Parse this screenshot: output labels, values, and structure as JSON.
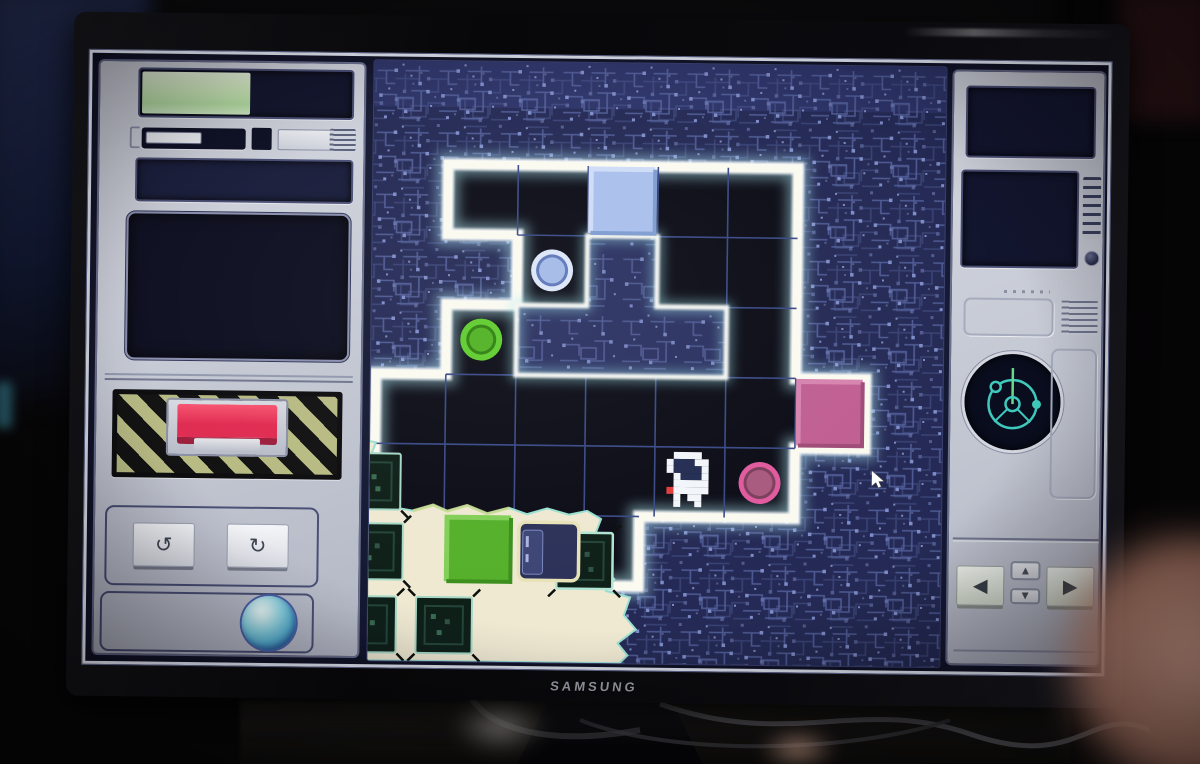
{
  "monitor": {
    "brand": "SAMSUNG"
  },
  "hud": {
    "left_panel": {
      "progress_bar": {
        "value_percent": 51,
        "fill_color": "#cdeab8",
        "track_color": "#10132a"
      },
      "slider": {
        "state": "handle-left"
      },
      "display_small": {
        "content": "blank"
      },
      "display_large": {
        "content": "blank"
      },
      "alert_button": {
        "color_hex": "#ef2f58",
        "background": "hazard-stripes",
        "stripe_colors": [
          "#b7ba82",
          "#101010"
        ]
      },
      "undo_button": {
        "glyph": "↺",
        "icon": "rotate-ccw"
      },
      "redo_button": {
        "glyph": "↻",
        "icon": "rotate-cw"
      },
      "power_orb": {
        "color_hex": "#6cc4d8"
      }
    },
    "right_panel": {
      "display_top": {
        "content": "blank"
      },
      "display_vented": {
        "content": "blank",
        "knob": true,
        "vent_slats": 7
      },
      "gyro_display": {
        "icon": "gyroscope-radar",
        "color_hex": "#3fc9bd",
        "needle_color_hex": "#66d98a"
      },
      "prev_button": {
        "glyph": "◀"
      },
      "next_button": {
        "glyph": "▶"
      },
      "up_button": {
        "glyph": "▲"
      },
      "down_button": {
        "glyph": "▼"
      }
    }
  },
  "board": {
    "theme": "circuit-board",
    "grid": {
      "cols": 7,
      "rows": 6,
      "cell_px": 70
    },
    "walkable_map_rows": [
      ".OOOOO.",
      "..O#OO.",
      ".O###O.",
      "OOOOOOO",
      "OOOOOO.",
      "cc c..."
    ],
    "walls": [
      {
        "shape": "T",
        "cells": [
          [
            3,
            1
          ],
          [
            2,
            2
          ],
          [
            3,
            2
          ],
          [
            4,
            2
          ]
        ]
      }
    ],
    "items": [
      {
        "type": "tile-square",
        "color": "blue",
        "hex": "#a9c0ec",
        "col": 3,
        "row": 0
      },
      {
        "type": "tile-square",
        "color": "pink",
        "hex": "#c05f92",
        "col": 6,
        "row": 3
      },
      {
        "type": "tile-square",
        "color": "green",
        "hex": "#55b02a",
        "col": 1,
        "row": 5
      },
      {
        "type": "button-circle",
        "color": "blue",
        "hex": "#9db7e6",
        "col": 2,
        "row": 1
      },
      {
        "type": "button-circle",
        "color": "green",
        "hex": "#4fb122",
        "col": 1,
        "row": 2
      },
      {
        "type": "button-circle",
        "color": "pink",
        "hex": "#a85a7e",
        "col": 5,
        "row": 4
      },
      {
        "type": "robot-player",
        "col": 4,
        "row": 4
      },
      {
        "type": "empty-socket",
        "border_hex": "#e8e2b8",
        "col": 2,
        "row": 5
      },
      {
        "type": "chip",
        "zone": "cream",
        "count": 5
      }
    ],
    "cream_zone": {
      "color_hex": "#efe9d2",
      "position": "bottom-left"
    },
    "cursor": {
      "x": 872,
      "y": 467
    }
  },
  "colors": {
    "red": "#e02a50",
    "red-hi": "#f7536f",
    "red-sh": "#9c1d3c",
    "silver": "#c6cad3",
    "navy": "#10132a",
    "glow": "#fbfaf2",
    "circuit-base": "#242a55",
    "circuit-trace": "#5a68ae",
    "level-black": "#0b0c16",
    "cream": "#efe9d2",
    "teal": "#3fc9bd"
  }
}
